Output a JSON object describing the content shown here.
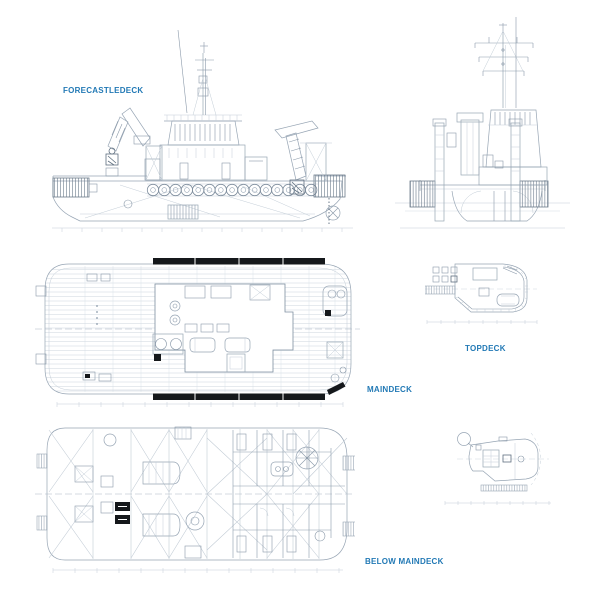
{
  "page": {
    "background_color": "#ffffff",
    "accent_color": "#2279b5",
    "line_color": "#93a2b2",
    "fender_color": "#15181b"
  },
  "labels": {
    "forecastledeck": "FORECASTLEDECK",
    "topdeck": "TOPDECK",
    "maindeck": "MAINDECK",
    "below_maindeck": "BELOW MAINDECK"
  }
}
